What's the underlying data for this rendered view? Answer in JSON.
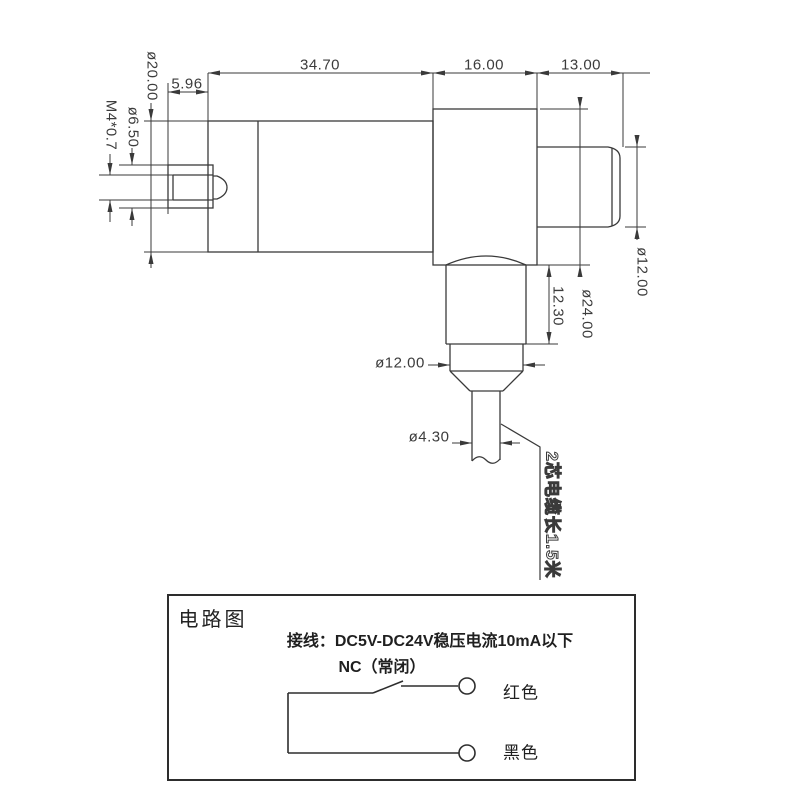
{
  "drawing": {
    "dims": {
      "body_length": "34.70",
      "block_length": "16.00",
      "tip_length": "13.00",
      "stud_protrusion": "5.96",
      "flange_diameter": "ø20.00",
      "stud_diameter": "ø6.50",
      "thread_spec": "M4*0.7",
      "tip_diameter": "ø12.00",
      "block_diameter": "ø24.00",
      "neck_length": "12.30",
      "gland_diameter": "ø12.00",
      "cable_diameter": "ø4.30"
    },
    "cable_note": "2芯电缆长1.5米"
  },
  "circuit": {
    "title": "电路图",
    "wiring_note": "接线：DC5V-DC24V稳压电流10mA以下",
    "contact_label": "NC（常闭）",
    "wire_labels": {
      "red": "红色",
      "black": "黑色"
    }
  },
  "colors": {
    "line": "#3a3a3a",
    "text": "#3c3c3c",
    "background": "#ffffff"
  }
}
